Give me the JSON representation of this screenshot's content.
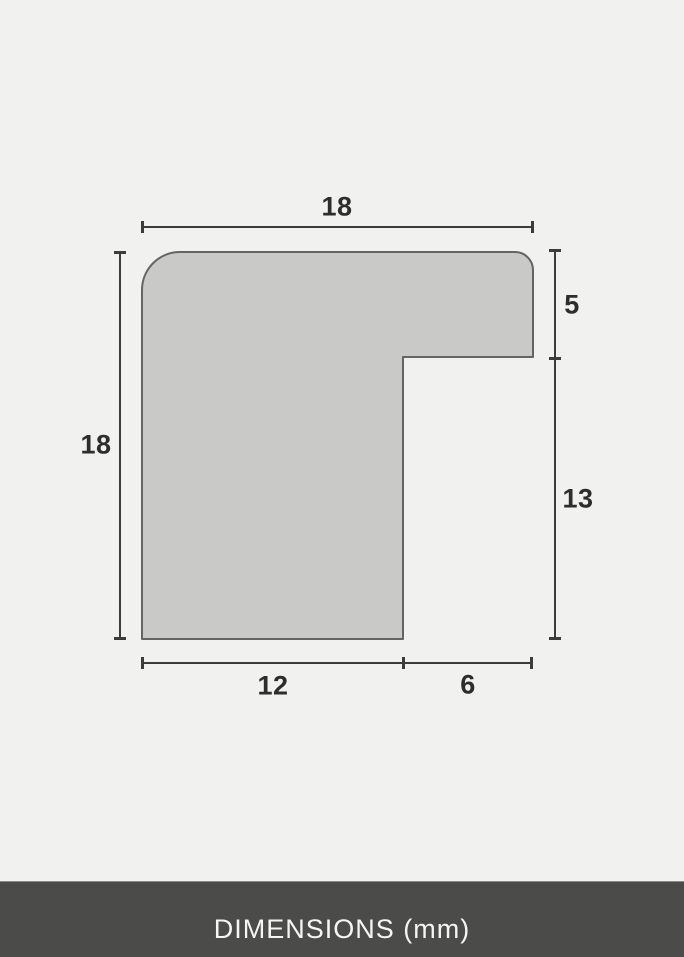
{
  "dimensions": {
    "top_width": "18",
    "left_height": "18",
    "right_upper": "5",
    "right_lower": "13",
    "bottom_left": "12",
    "bottom_right": "6"
  },
  "footer": {
    "label": "DIMENSIONS (mm)"
  },
  "colors": {
    "background": "#f1f1ef",
    "profile_fill": "#c9c9c8",
    "profile_stroke": "#646464",
    "dimension_lines": "#3c3c3c",
    "label_text": "#2d2d2d",
    "footer_background": "#4b4b49",
    "footer_text": "#f5f5f5"
  }
}
